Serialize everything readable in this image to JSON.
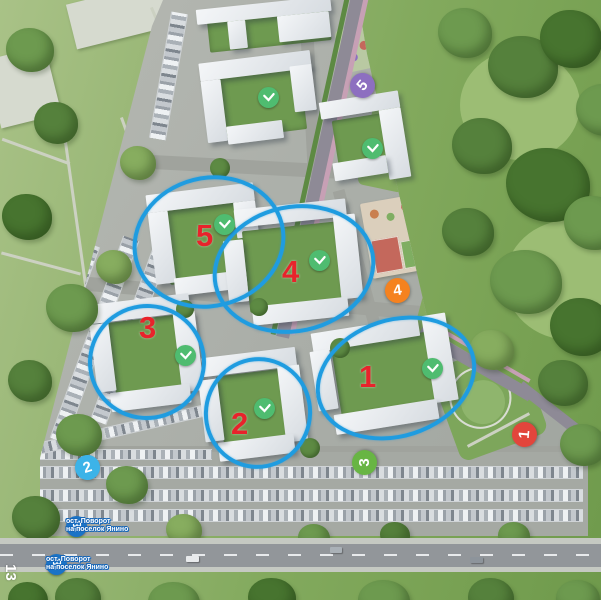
{
  "map": {
    "corner_number": "13",
    "highlight_circle_color": "#1f9ce0",
    "cluster_number_color": "#e8232b",
    "clusters": [
      {
        "number": "1"
      },
      {
        "number": "2"
      },
      {
        "number": "3"
      },
      {
        "number": "4"
      },
      {
        "number": "5"
      }
    ],
    "completed_badge": {
      "icon": "checkmark-icon",
      "color": "#4fbc70",
      "count": 7
    },
    "route_markers": [
      {
        "number": "1",
        "color": "#e2453c"
      },
      {
        "number": "2",
        "color": "#3cb3e8"
      },
      {
        "number": "3",
        "color": "#68b544"
      },
      {
        "number": "4",
        "color": "#f5821f"
      },
      {
        "number": "5",
        "color": "#8d6fc0"
      }
    ],
    "bus_stops": [
      {
        "line1": "ост. Поворот",
        "line2": "на поселок Янино"
      },
      {
        "line1": "ост. Поворот",
        "line2": "на поселок Янино"
      }
    ],
    "bus_icon_color": "#1a73c6"
  }
}
